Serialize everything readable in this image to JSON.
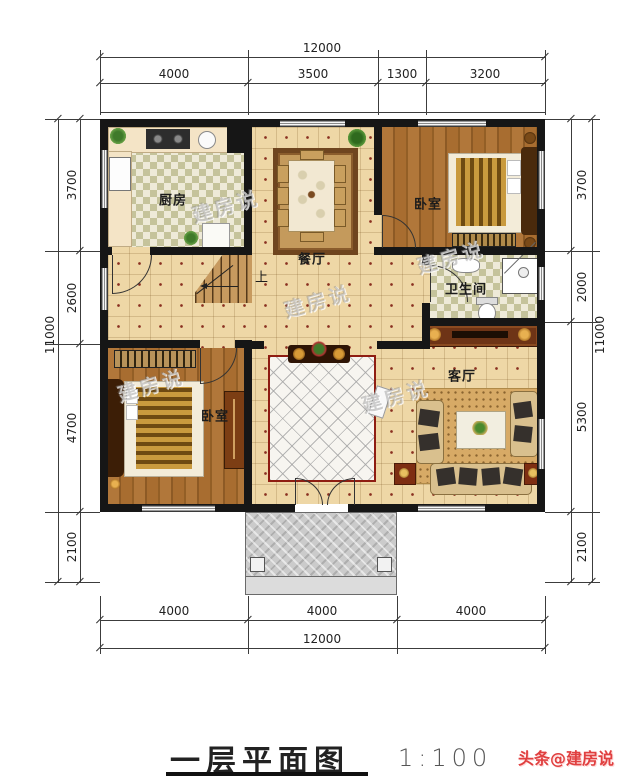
{
  "dimensions": {
    "top": {
      "overall": "12000",
      "segments": [
        "4000",
        "3500",
        "1300",
        "3200"
      ]
    },
    "bottom": {
      "overall": "12000",
      "segments": [
        "4000",
        "4000",
        "4000"
      ]
    },
    "left": {
      "overall": "11000",
      "segments": [
        "3700",
        "2600",
        "4700",
        "2100"
      ]
    },
    "right": {
      "overall": "11000",
      "segments": [
        "3700",
        "2000",
        "5300",
        "2100"
      ]
    }
  },
  "rooms": {
    "kitchen": {
      "label": "厨房"
    },
    "dining": {
      "label": "餐厅"
    },
    "bedroom_top_right": {
      "label": "卧室"
    },
    "bathroom": {
      "label": "卫生间"
    },
    "bedroom_bottom_left": {
      "label": "卧室"
    },
    "living": {
      "label": "客厅"
    }
  },
  "stairs": {
    "up": "上"
  },
  "watermark": {
    "text": "建房说"
  },
  "footer": {
    "title": "一层平面图",
    "scale": "1:100",
    "credit": "头条@建房说"
  },
  "colors": {
    "wall": "#161616",
    "floor_tile": "#eed7a6",
    "checker_olive": "#c5c39b",
    "wood": "#a9702f",
    "rug_red_border": "#8e1d12",
    "credit_red": "#e04040",
    "porch_gray": "#cbcbcb"
  }
}
